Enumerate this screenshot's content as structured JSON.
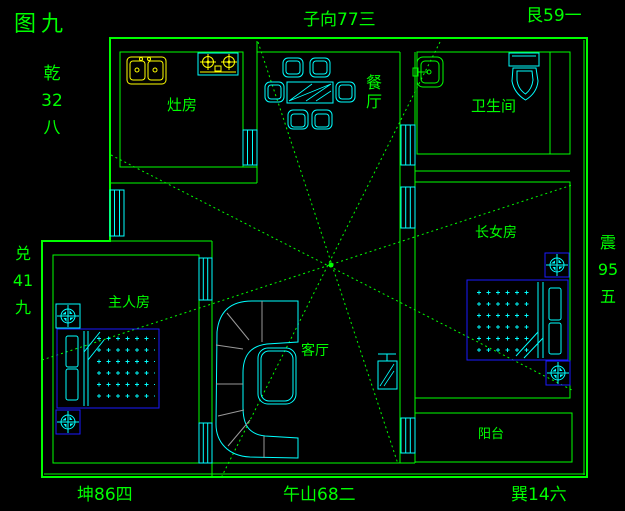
{
  "figure": {
    "title": "图九"
  },
  "compass": {
    "northwest": [
      "乾",
      "32",
      "八"
    ],
    "north": "子向77三",
    "northeast": "艮59一",
    "west": [
      "兑",
      "41",
      "九"
    ],
    "east": [
      "震",
      "95",
      "五"
    ],
    "southwest": "坤86四",
    "south": "午山68二",
    "southeast": "巽14六"
  },
  "rooms": {
    "kitchen": {
      "label": "灶房"
    },
    "dining": {
      "label": "餐厅"
    },
    "bathroom": {
      "label": "卫生间"
    },
    "eldest_daughter": {
      "label": "长女房"
    },
    "master": {
      "label": "主人房"
    },
    "living": {
      "label": "客厅"
    },
    "balcony": {
      "label": "阳台"
    }
  },
  "colors": {
    "background": "#000000",
    "wall_green": "#00ff00",
    "furniture_cyan": "#00ffff",
    "fixture_yellow": "#ffff00",
    "bed_blue": "#1a1aff",
    "sofa_gray": "#999999"
  }
}
